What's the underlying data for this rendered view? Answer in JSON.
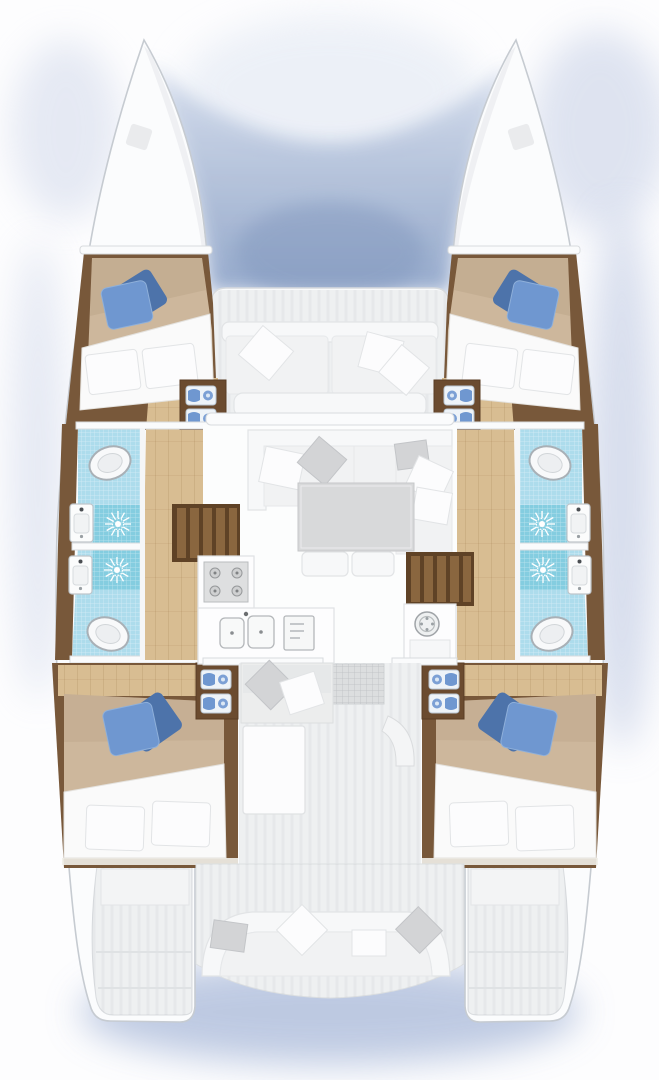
{
  "diagram": {
    "type": "boat-floor-plan",
    "vessel": "catamaran",
    "view": "overhead",
    "hull_count": 2,
    "cabin_count": 4,
    "bathroom_count": 4,
    "shower_count": 4,
    "toilet_count": 4,
    "washbasin_count": 4,
    "staircase_count": 2,
    "objects": [
      "double-bed",
      "blue-decorative-pillows",
      "white-pillows",
      "towel-shelf",
      "shower-sunburst",
      "toilet",
      "washbasin",
      "hull-corridor",
      "saloon-sofa",
      "saloon-table",
      "stools",
      "galley-stove",
      "double-sink",
      "oven",
      "washing-machine",
      "forward-cockpit-bench",
      "aft-cockpit-bench",
      "doormat",
      "helm-steps",
      "transom-steps",
      "trampoline-shadow",
      "deck-hatch"
    ]
  },
  "colors": {
    "hull_white": "#fbfcfd",
    "hull_edge": "#c6cbd1",
    "deck_gray": "#eef0f1",
    "deck_line": "#dfe2e4",
    "wood_dark": "#78583a",
    "wood_frame": "#6b4b2f",
    "wood_light": "#d8bd92",
    "plank_line": "#c2a276",
    "bed_tan": "#cdb79c",
    "bed_tan_shadow": "#b59e80",
    "linen": "#fafafa",
    "linen_line": "#e4e2de",
    "pillow_gray": "#d3d4d6",
    "pillow_blue": "#6f97d0",
    "pillow_blue_dark": "#4d73aa",
    "tile": "#addcec",
    "tile_deep": "#84cde0",
    "fixture_stroke": "#a9b0b6",
    "table_gray": "#d8d9da",
    "stair_dark": "#5f4226",
    "stair_light": "#8a663f",
    "shadow_blue": "#b9c5e0",
    "trampoline_blue": "#8ea4c9",
    "appliance_gray": "#dedfe0"
  }
}
